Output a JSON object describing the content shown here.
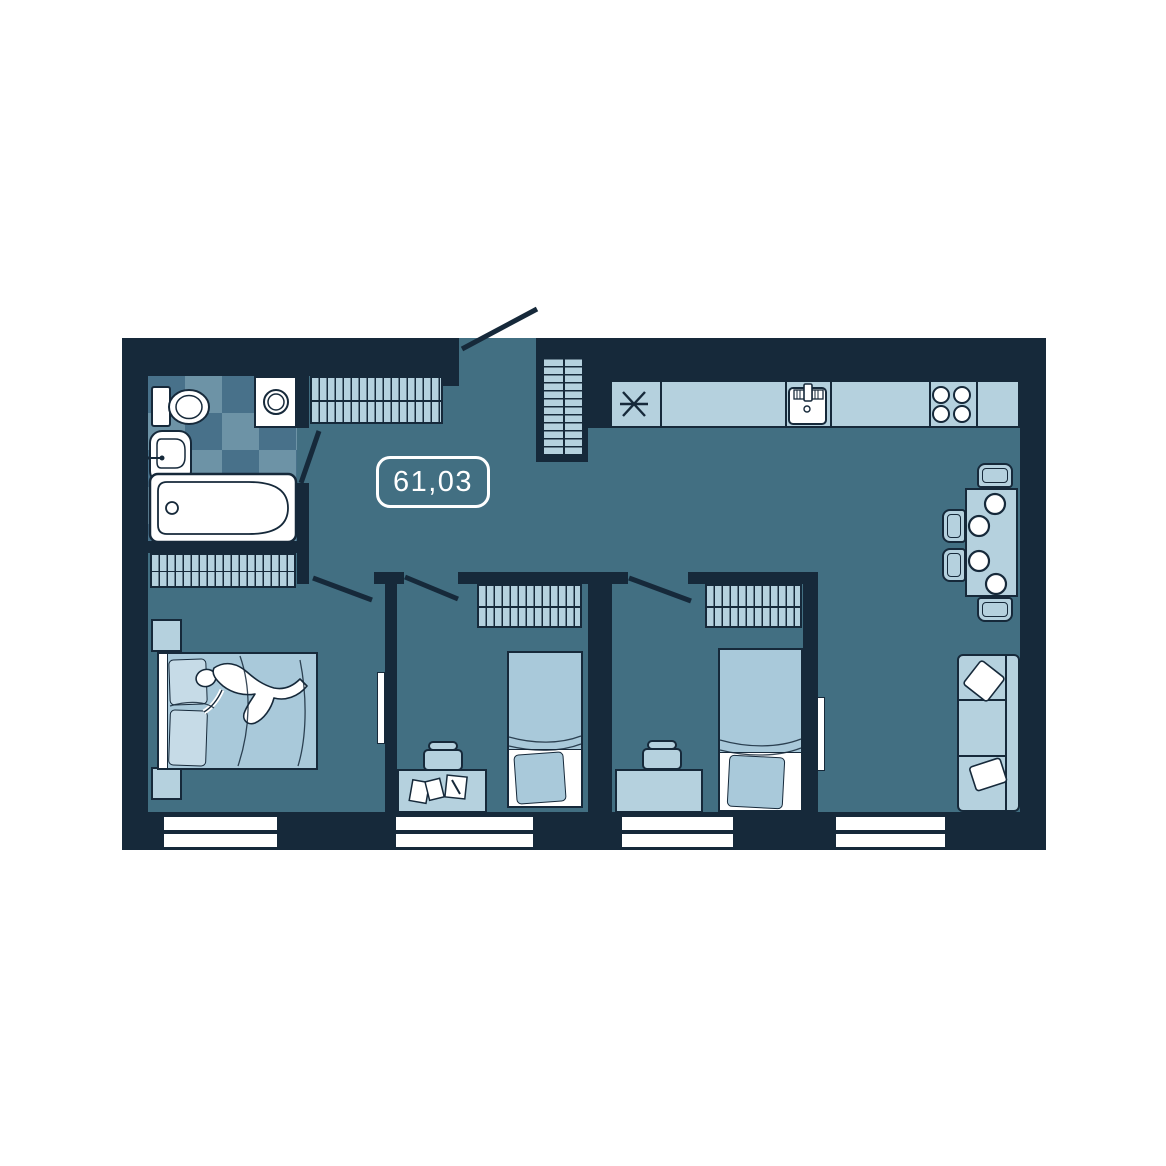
{
  "meta": {
    "type": "apartment-floor-plan"
  },
  "plan": {
    "area_label": "61,03",
    "theme": {
      "background": "#ffffff",
      "wall": "#16293a",
      "line": "#16293a",
      "floor": "#426f82",
      "furniture-light": "#b5d1de",
      "bed": "#a9c9da",
      "pillow": "#c6dbe7",
      "tile-a": "#48718a",
      "tile-b": "#6d93a6",
      "white": "#ffffff"
    },
    "rooms": {
      "bathroom": {
        "items": [
          "toilet",
          "washing-machine",
          "sink",
          "bathtub",
          "door"
        ]
      },
      "hallway": {
        "items": [
          "wardrobe",
          "coat-rack",
          "entrance-door",
          "area-label"
        ]
      },
      "kitchen_living": {
        "items": [
          "fridge",
          "kitchen-counter",
          "kitchen-sink",
          "stove",
          "dining-table",
          "chairs",
          "plates",
          "sofa",
          "tv",
          "window"
        ]
      },
      "bedroom_master": {
        "items": [
          "wardrobe",
          "double-bed",
          "person",
          "nightstand",
          "nightstand",
          "tv",
          "window",
          "door"
        ]
      },
      "bedroom_2": {
        "items": [
          "wardrobe",
          "single-bed",
          "desk",
          "chair",
          "papers",
          "window",
          "door"
        ]
      },
      "bedroom_3": {
        "items": [
          "wardrobe",
          "single-bed",
          "desk",
          "chair",
          "window",
          "door"
        ]
      }
    }
  }
}
